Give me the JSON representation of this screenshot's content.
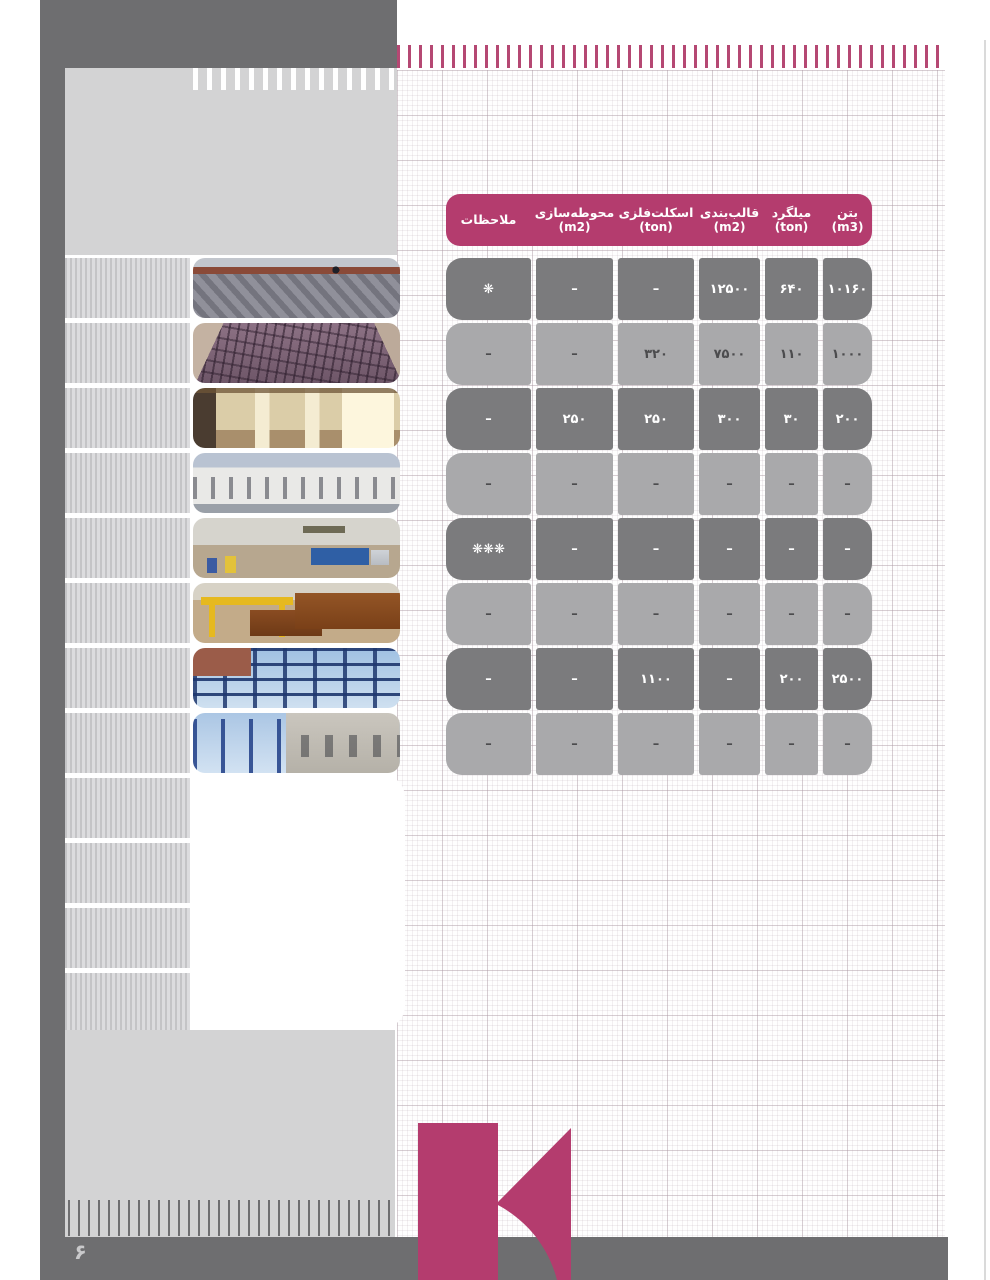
{
  "page": {
    "number": "۶"
  },
  "colors": {
    "accent_magenta": "#b43c6e",
    "tick_pink": "#b54873",
    "dark_gray": "#6e6e70",
    "row_dark": "#7b7b7d",
    "row_light": "#a9a9ab",
    "block_light_gray": "#d3d3d4"
  },
  "table": {
    "headers": [
      {
        "title": "ملاحظات",
        "unit": ""
      },
      {
        "title": "محوطه‌سازی",
        "unit": "(m2)"
      },
      {
        "title": "اسکلت‌فلزی",
        "unit": "(ton)"
      },
      {
        "title": "قالب‌بندی",
        "unit": "(m2)"
      },
      {
        "title": "میلگرد",
        "unit": "(ton)"
      },
      {
        "title": "بتن",
        "unit": "(m3)"
      }
    ],
    "rows": [
      {
        "tone": "dark",
        "cells": [
          "❋",
          "–",
          "–",
          "۱۲۵۰۰",
          "۶۴۰",
          "۱۰۱۶۰"
        ]
      },
      {
        "tone": "light",
        "cells": [
          "–",
          "–",
          "۳۲۰",
          "۷۵۰۰",
          "۱۱۰",
          "۱۰۰۰"
        ]
      },
      {
        "tone": "dark",
        "cells": [
          "–",
          "۲۵۰",
          "۲۵۰",
          "۳۰۰",
          "۳۰",
          "۲۰۰"
        ]
      },
      {
        "tone": "light",
        "cells": [
          "–",
          "–",
          "–",
          "–",
          "–",
          "–"
        ]
      },
      {
        "tone": "dark",
        "cells": [
          "❋❋❋",
          "–",
          "–",
          "–",
          "–",
          "–"
        ]
      },
      {
        "tone": "light",
        "cells": [
          "–",
          "–",
          "–",
          "–",
          "–",
          "–"
        ]
      },
      {
        "tone": "dark",
        "cells": [
          "–",
          "–",
          "۱۱۰۰",
          "–",
          "۲۰۰",
          "۲۵۰۰"
        ]
      },
      {
        "tone": "light",
        "cells": [
          "–",
          "–",
          "–",
          "–",
          "–",
          "–"
        ]
      }
    ]
  },
  "photos": [
    {
      "label": "stone retaining wall with scaffolding and worker"
    },
    {
      "label": "rebar mesh foundation slab"
    },
    {
      "label": "building interior hall with columns"
    },
    {
      "label": "white residential apartment buildings"
    },
    {
      "label": "excavator loading dump truck with workers"
    },
    {
      "label": "yellow gantry crane with steel pipe sections"
    },
    {
      "label": "blue steel frame structure"
    },
    {
      "label": "concrete building under construction with steel columns"
    }
  ]
}
